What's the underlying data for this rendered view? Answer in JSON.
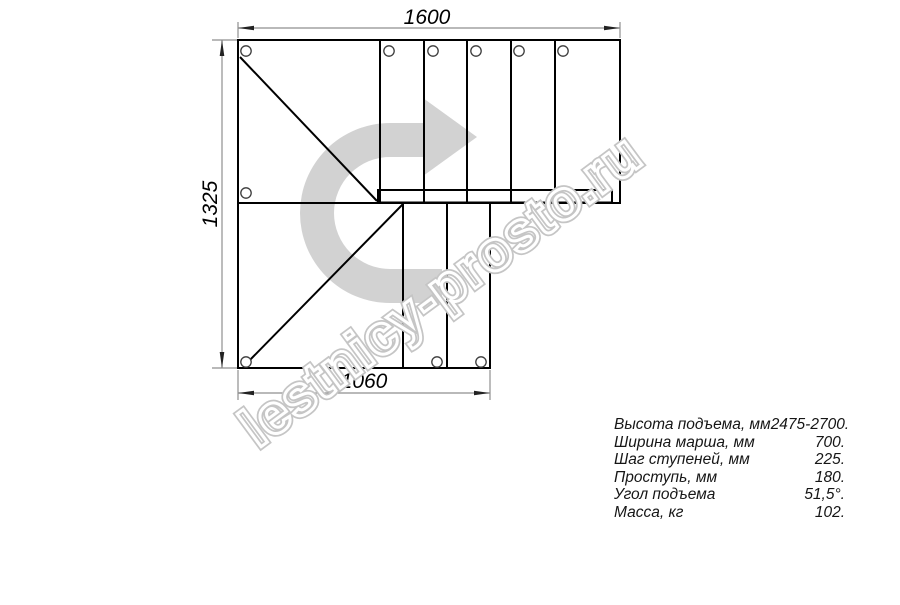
{
  "drawing": {
    "dim_top": "1600",
    "dim_left": "1325",
    "dim_bottom": "1060"
  },
  "watermark": "lestnicy-prosto.ru",
  "specs": {
    "rows": [
      {
        "label": "Высота подъема, мм",
        "value": "2475-2700."
      },
      {
        "label": "Ширина марша, мм",
        "value": "700."
      },
      {
        "label": "Шаг ступеней, мм",
        "value": "225."
      },
      {
        "label": "Проступь, мм",
        "value": "180."
      },
      {
        "label": "Угол подъема",
        "value": "51,5°."
      },
      {
        "label": "Масса, кг",
        "value": "102."
      }
    ]
  },
  "colors": {
    "line": "#000000",
    "dimension": "#8f8f8f",
    "arrow_fill": "#d2d2d2",
    "watermark_stroke": "#c5c5c5"
  }
}
